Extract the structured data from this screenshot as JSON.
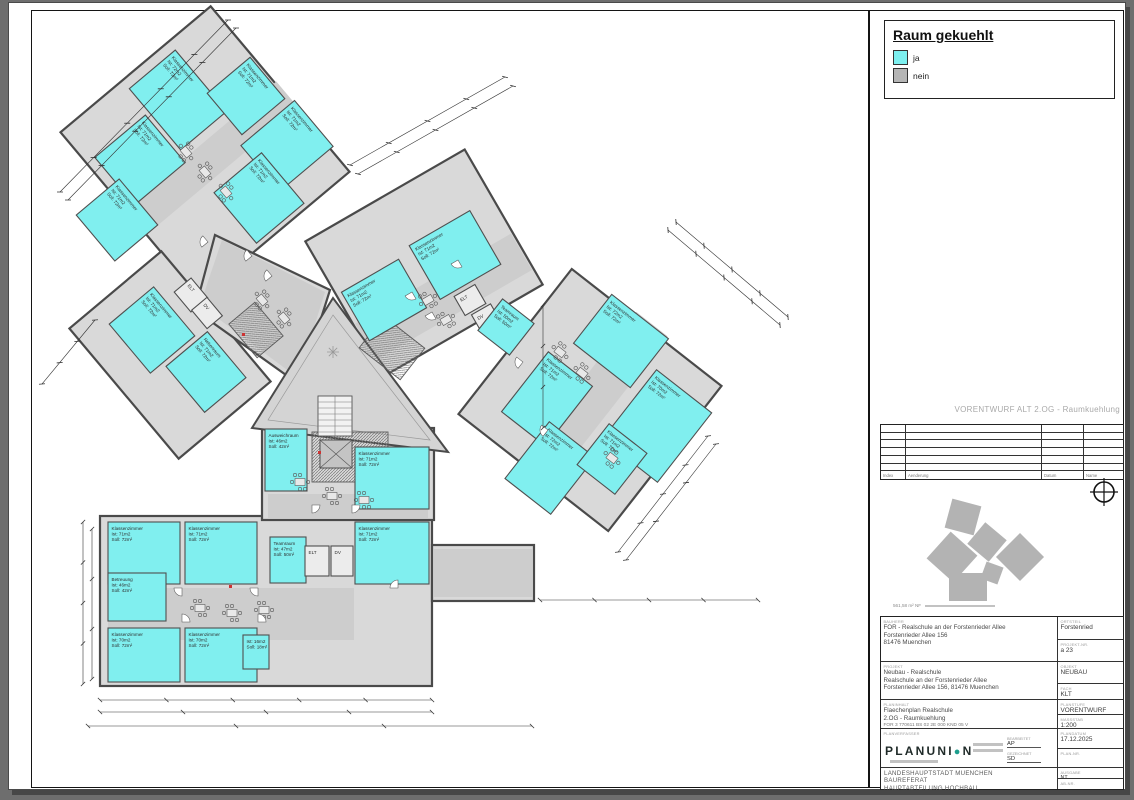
{
  "banner": "VORENTWURF ALT 2.OG - Raumkuehlung",
  "legend": {
    "title": "Raum gekuehlt",
    "items": [
      {
        "label": "ja",
        "color": "#7df0f0"
      },
      {
        "label": "nein",
        "color": "#b5b5b5"
      }
    ]
  },
  "revision_table": {
    "headers": [
      "Index",
      "Aenderung",
      "Datum",
      "Name"
    ]
  },
  "key_plan": {
    "caption": "561,58 m² NF"
  },
  "title_block": {
    "labels": {
      "client": "BAUHERR",
      "project": "PROJEKT",
      "content": "PLANINHALT",
      "author": "PLANVERFASSER",
      "district": "ORTSTEIL",
      "project_no": "PROJEKT-NR.",
      "object": "OBJEKT",
      "discipline": "FACH",
      "phase": "PLANSTUFE",
      "scale": "MASSSTAB",
      "date": "PLANDATUM",
      "plan_no": "PLAN-NR.",
      "issue": "AUSGABE",
      "ab_no": "AB-NR.",
      "edited": "BEARBEITET",
      "drawn": "GEZEICHNET"
    },
    "client": {
      "lines": [
        "FOR - Realschule an der Forstenrieder Allee",
        "Forstenrieder Allee 156",
        "81476 Muenchen"
      ]
    },
    "project": {
      "lines": [
        "Neubau - Realschule",
        "Realschule an der Forstenrieder Allee",
        "Forstenrieder Allee 156, 81476 Muenchen"
      ]
    },
    "content": {
      "lines": [
        "Flaechenplan Realschule",
        "2.OG - Raumkuehlung",
        "FOR 3 770611 BS 02 2E 000 KND 05 V"
      ]
    },
    "values": {
      "district": "Forstenried",
      "project_no": "a 23",
      "object": "NEUBAU",
      "discipline": "KLT",
      "phase": "VORENTWURF",
      "scale": "1:200",
      "date": "17.12.2025",
      "plan_no": "",
      "issue": "NT",
      "ab_no": "",
      "edited": "AP",
      "drawn": "SD"
    },
    "logo": {
      "left": "PLANUNI",
      "o": "●",
      "right": "N"
    },
    "owner": {
      "lines": [
        "LANDESHAUPTSTADT MUENCHEN",
        "BAUREFERAT",
        "HAUPTABTEILUNG HOCHBAU"
      ]
    }
  },
  "plan": {
    "colors": {
      "cooled": "#80efef",
      "uncooled": "#ececec",
      "wall": "#4d4d4d",
      "body": "#d9d9d9",
      "corridor": "#cdcdcd"
    },
    "rooms": [
      {
        "x": 178,
        "y": 100,
        "w": 80,
        "h": 60,
        "r": 50,
        "cooled": true,
        "lines": [
          "Klassenzimmer",
          "Ist: 72m2",
          "Soll: 72m²"
        ]
      },
      {
        "x": 246,
        "y": 96,
        "w": 54,
        "h": 56,
        "r": 50,
        "cooled": true,
        "lines": [
          "Klassenzimmer",
          "Ist: 71m2",
          "Soll: 72m²"
        ]
      },
      {
        "x": 287,
        "y": 146,
        "w": 60,
        "h": 70,
        "r": 50,
        "cooled": true,
        "lines": [
          "Klassenzimmer",
          "Ist: 71m2",
          "Soll: 72m²"
        ]
      },
      {
        "x": 140,
        "y": 160,
        "w": 62,
        "h": 66,
        "r": 50,
        "cooled": true,
        "lines": [
          "Klassenzimmer",
          "Ist: 71m2",
          "Soll: 72m²"
        ]
      },
      {
        "x": 117,
        "y": 220,
        "w": 60,
        "h": 56,
        "r": 50,
        "cooled": true,
        "lines": [
          "Klassenzimmer",
          "Ist: 71m2",
          "Soll: 72m²"
        ]
      },
      {
        "x": 259,
        "y": 198,
        "w": 66,
        "h": 62,
        "r": 50,
        "cooled": true,
        "lines": [
          "Klassenzimmer",
          "Ist: 71m2",
          "Soll: 72m²"
        ]
      },
      {
        "x": 152,
        "y": 330,
        "w": 64,
        "h": 58,
        "r": 50,
        "cooled": true,
        "lines": [
          "Klassenzimmer",
          "Ist: 71m2",
          "Soll: 72m²"
        ]
      },
      {
        "x": 206,
        "y": 372,
        "w": 60,
        "h": 54,
        "r": 50,
        "cooled": true,
        "lines": [
          "Nebenraum",
          "Ist: 71m2",
          "Soll: 72m²"
        ]
      },
      {
        "x": 191,
        "y": 295,
        "w": 26,
        "h": 22,
        "r": 50,
        "cooled": false,
        "lines": [
          "ELT"
        ]
      },
      {
        "x": 207,
        "y": 313,
        "w": 24,
        "h": 20,
        "r": 50,
        "cooled": false,
        "lines": [
          "DV"
        ]
      },
      {
        "x": 384,
        "y": 300,
        "w": 66,
        "h": 56,
        "r": -30,
        "cooled": true,
        "lines": [
          "Klassenzimmer",
          "Ist: 71m2",
          "Soll: 72m²"
        ]
      },
      {
        "x": 455,
        "y": 255,
        "w": 70,
        "h": 62,
        "r": -30,
        "cooled": true,
        "lines": [
          "Klassenzimmer",
          "Ist: 71m2",
          "Soll: 72m²"
        ]
      },
      {
        "x": 470,
        "y": 300,
        "w": 24,
        "h": 22,
        "r": -30,
        "cooled": false,
        "lines": [
          "ELT"
        ]
      },
      {
        "x": 486,
        "y": 318,
        "w": 22,
        "h": 20,
        "r": -30,
        "cooled": false,
        "lines": [
          "DV"
        ]
      },
      {
        "x": 506,
        "y": 327,
        "w": 40,
        "h": 40,
        "r": 38,
        "cooled": true,
        "lines": [
          "Teamraum",
          "Ist: 50m2",
          "Soll: 50m²"
        ]
      },
      {
        "x": 621,
        "y": 341,
        "w": 72,
        "h": 62,
        "r": 38,
        "cooled": true,
        "lines": [
          "Klassenzimmer",
          "Ist: 72m2",
          "Soll: 72m²"
        ]
      },
      {
        "x": 547,
        "y": 399,
        "w": 56,
        "h": 76,
        "r": 38,
        "cooled": true,
        "lines": [
          "Klassenzimmer",
          "Ist: 71m2",
          "Soll: 72m²"
        ]
      },
      {
        "x": 657,
        "y": 426,
        "w": 70,
        "h": 88,
        "r": 38,
        "cooled": true,
        "lines": [
          "Klassenzimmer",
          "Ist: 70m2",
          "Soll: 72m²"
        ]
      },
      {
        "x": 550,
        "y": 468,
        "w": 58,
        "h": 72,
        "r": 38,
        "cooled": true,
        "lines": [
          "Klassenzimmer",
          "Ist: 72m2",
          "Soll: 72m²"
        ]
      },
      {
        "x": 612,
        "y": 459,
        "w": 48,
        "h": 52,
        "r": 38,
        "cooled": true,
        "lines": [
          "Klassenzimmer",
          "Ist: 71m2",
          "Soll: 72m²"
        ]
      },
      {
        "x": 286,
        "y": 460,
        "w": 42,
        "h": 62,
        "r": 0,
        "cooled": true,
        "lines": [
          "Ausweichraum",
          "Ist: 46m2",
          "Soll: 42m²"
        ]
      },
      {
        "x": 392,
        "y": 478,
        "w": 74,
        "h": 62,
        "r": 0,
        "cooled": true,
        "lines": [
          "Klassenzimmer",
          "Ist: 71m2",
          "Soll: 72m²"
        ]
      },
      {
        "x": 144,
        "y": 553,
        "w": 72,
        "h": 62,
        "r": 0,
        "cooled": true,
        "lines": [
          "Klassenzimmer",
          "Ist: 71m2",
          "Soll: 72m²"
        ]
      },
      {
        "x": 221,
        "y": 553,
        "w": 72,
        "h": 62,
        "r": 0,
        "cooled": true,
        "lines": [
          "Klassenzimmer",
          "Ist: 71m2",
          "Soll: 72m²"
        ]
      },
      {
        "x": 137,
        "y": 597,
        "w": 58,
        "h": 48,
        "r": 0,
        "cooled": true,
        "lines": [
          "Betreuung",
          "Ist: 46m2",
          "Soll: 42m²"
        ]
      },
      {
        "x": 144,
        "y": 655,
        "w": 72,
        "h": 54,
        "r": 0,
        "cooled": true,
        "lines": [
          "Klassenzimmer",
          "Ist: 70m2",
          "Soll: 72m²"
        ]
      },
      {
        "x": 221,
        "y": 655,
        "w": 72,
        "h": 54,
        "r": 0,
        "cooled": true,
        "lines": [
          "Klassenzimmer",
          "Ist: 70m2",
          "Soll: 72m²"
        ]
      },
      {
        "x": 392,
        "y": 553,
        "w": 74,
        "h": 62,
        "r": 0,
        "cooled": true,
        "lines": [
          "Klassenzimmer",
          "Ist: 71m2",
          "Soll: 72m²"
        ]
      },
      {
        "x": 288,
        "y": 560,
        "w": 36,
        "h": 46,
        "r": 0,
        "cooled": true,
        "lines": [
          "Teamraum",
          "Ist: 47m2",
          "Soll: 50m²"
        ]
      },
      {
        "x": 317,
        "y": 561,
        "w": 24,
        "h": 30,
        "r": 0,
        "cooled": false,
        "lines": [
          "ELT"
        ]
      },
      {
        "x": 342,
        "y": 561,
        "w": 22,
        "h": 30,
        "r": 0,
        "cooled": false,
        "lines": [
          "DV"
        ]
      },
      {
        "x": 256,
        "y": 652,
        "w": 26,
        "h": 34,
        "r": 0,
        "cooled": true,
        "lines": [
          "Ist: 16m2",
          "Soll: 18m²"
        ]
      }
    ]
  }
}
